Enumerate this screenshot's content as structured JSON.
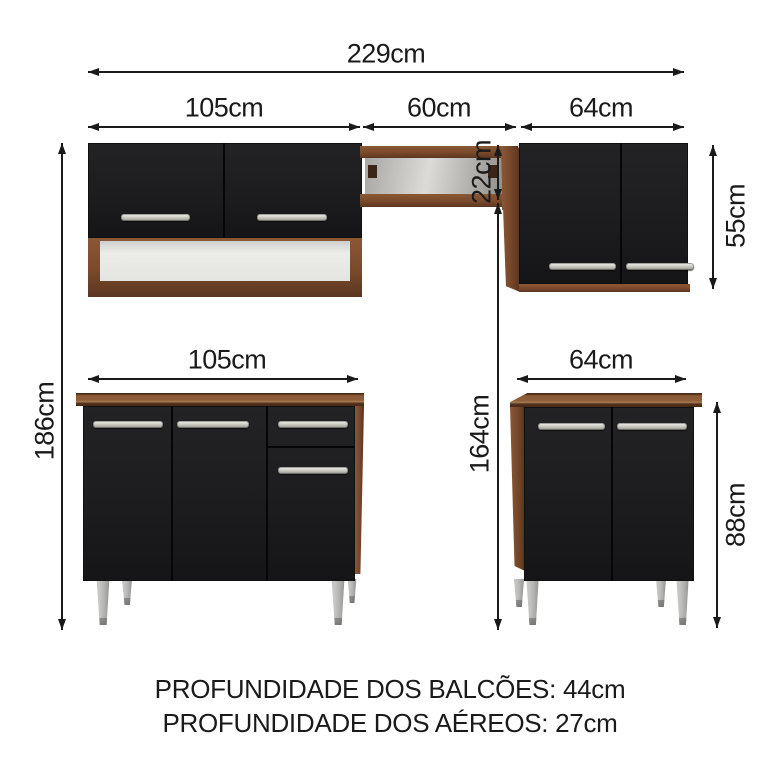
{
  "dims": {
    "total_width": "229cm",
    "upper_left_width": "105cm",
    "upper_middle_width": "60cm",
    "upper_right_width": "64cm",
    "total_height": "186cm",
    "upper_middle_height": "22cm",
    "lower_span_height": "164cm",
    "upper_right_height": "55cm",
    "lower_left_width": "105cm",
    "lower_right_width": "64cm",
    "lower_right_height": "88cm"
  },
  "footer": {
    "line1": "PROFUNDIDADE DOS BALCÕES: 44cm",
    "line2": "PROFUNDIDADE DOS AÉREOS: 27cm"
  },
  "colors": {
    "background": "#ffffff",
    "dim_line": "#1a1a1a",
    "door_black": "#1e1e20",
    "wood": "#7a4a2b",
    "wood_light": "#96643c",
    "wood_dark": "#4e2f1b",
    "handle_silver": "#cfcfc7",
    "leg_silver": "#bcbcba",
    "shelf_interior": "#dddbd7"
  }
}
